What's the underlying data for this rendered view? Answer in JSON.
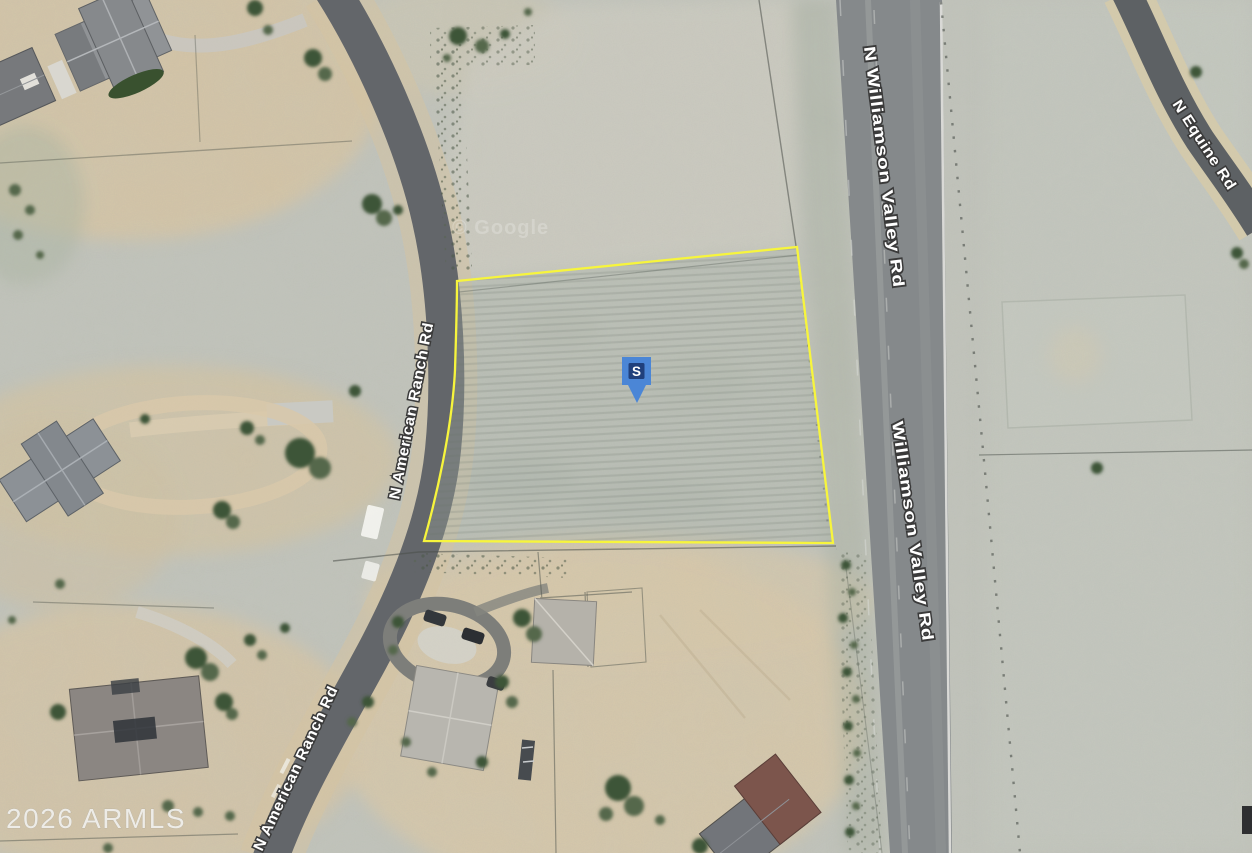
{
  "map": {
    "view": "satellite",
    "labels": {
      "road_american_ranch": "N American Ranch Rd",
      "road_n_williamson_valley": "N Williamson Valley Rd",
      "road_williamson_valley": "Williamson Valley Rd",
      "road_equine": "N Equine Rd"
    },
    "marker": {
      "letter": "S",
      "outer_color": "#4b86d6",
      "inner_color": "#20407c"
    },
    "parcel": {
      "outline_color": "#f7f53c"
    },
    "watermarks": {
      "imagery": "© Google",
      "mls": "2026 ARMLS"
    }
  }
}
